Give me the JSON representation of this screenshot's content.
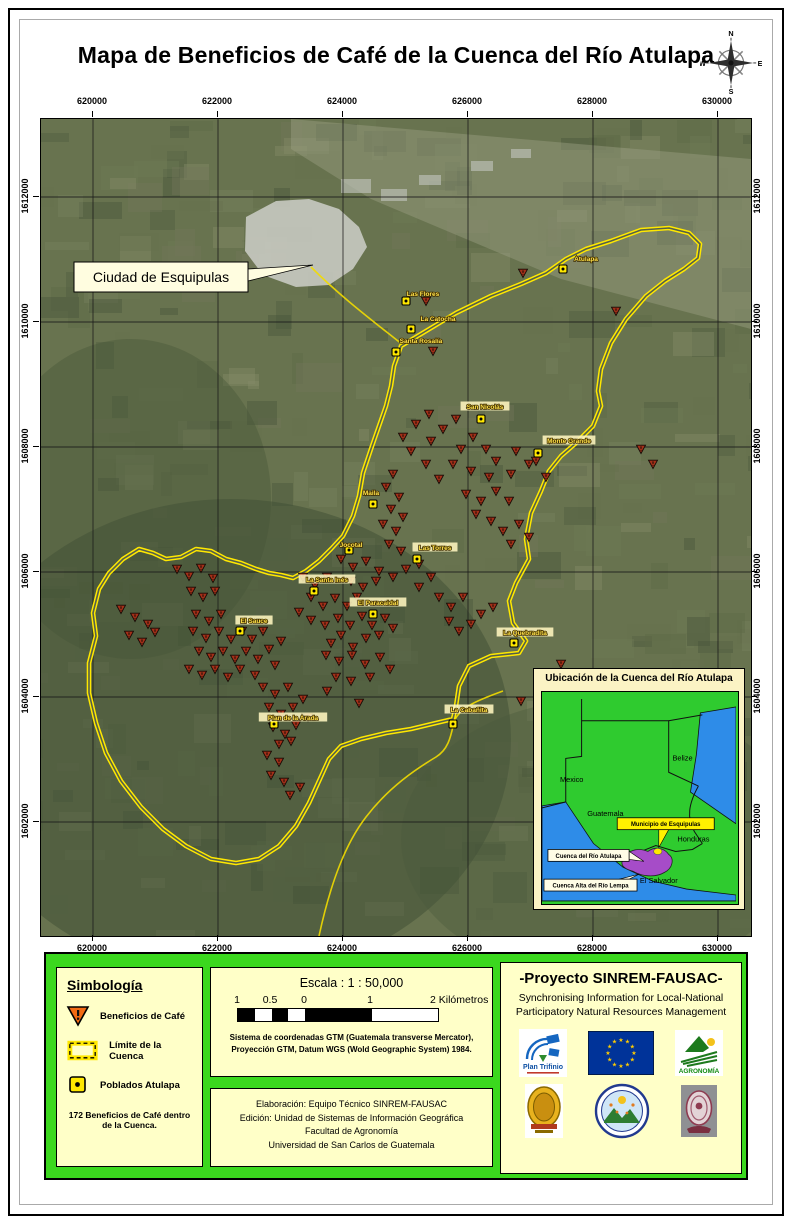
{
  "title": "Mapa de Beneficios de Café de la Cuenca del Río Atulapa",
  "compass": {
    "n": "N",
    "e": "E",
    "s": "S",
    "w": "W"
  },
  "map": {
    "x_ticks": [
      "620000",
      "622000",
      "624000",
      "626000",
      "628000",
      "630000"
    ],
    "y_ticks": [
      "1612000",
      "1610000",
      "1608000",
      "1606000",
      "1604000",
      "1602000"
    ],
    "city_callout": "Ciudad de Esquipulas",
    "boundary_points": "360,227 385,212 415,194 450,177 480,165 505,154 525,140 545,130 570,122 600,111 628,109 648,114 659,125 657,139 643,150 624,162 605,177 585,200 570,224 560,250 557,272 560,287 552,307 535,324 520,337 508,352 500,372 490,394 485,420 488,440 475,464 468,482 472,504 485,522 478,534 450,537 428,547 418,567 415,587 412,600 395,604 370,610 345,614 320,620 300,627 288,640 278,662 268,684 255,707 238,727 218,740 195,744 170,740 145,727 122,710 100,688 80,662 65,634 55,604 48,574 48,544 55,517 52,494 58,470 68,454 82,440 98,430 112,434 125,440 140,438 155,430 170,432 185,440 200,444 215,450 228,454 240,456 252,459 265,452 278,442 290,430 302,417 312,397 318,377 322,354 330,330 338,307 345,287 350,267 353,247",
    "towns": [
      {
        "name": "Atulapa",
        "lx": 545,
        "ly": 140,
        "mx": 522,
        "my": 150,
        "boxed": false
      },
      {
        "name": "Las Flores",
        "lx": 382,
        "ly": 175,
        "mx": 365,
        "my": 182,
        "boxed": false
      },
      {
        "name": "La Catocha",
        "lx": 397,
        "ly": 200,
        "mx": 370,
        "my": 210,
        "boxed": false
      },
      {
        "name": "Santa Rosalía",
        "lx": 380,
        "ly": 222,
        "mx": 355,
        "my": 233,
        "boxed": false
      },
      {
        "name": "San Nicolás",
        "lx": 444,
        "ly": 288,
        "mx": 440,
        "my": 300,
        "boxed": true
      },
      {
        "name": "Monte Grande",
        "lx": 528,
        "ly": 322,
        "mx": 497,
        "my": 334,
        "boxed": true
      },
      {
        "name": "Maila",
        "lx": 330,
        "ly": 374,
        "mx": 332,
        "my": 385,
        "boxed": false
      },
      {
        "name": "Jocotal",
        "lx": 310,
        "ly": 426,
        "mx": 308,
        "my": 431,
        "boxed": false
      },
      {
        "name": "Las Torres",
        "lx": 394,
        "ly": 429,
        "mx": 376,
        "my": 440,
        "boxed": true
      },
      {
        "name": "La Santa Inés",
        "lx": 286,
        "ly": 461,
        "mx": 273,
        "my": 472,
        "boxed": true
      },
      {
        "name": "El Paracaidal",
        "lx": 337,
        "ly": 484,
        "mx": 332,
        "my": 495,
        "boxed": true
      },
      {
        "name": "El Sauce",
        "lx": 213,
        "ly": 502,
        "mx": 199,
        "my": 512,
        "boxed": true
      },
      {
        "name": "La Quebradita",
        "lx": 484,
        "ly": 514,
        "mx": 473,
        "my": 524,
        "boxed": true
      },
      {
        "name": "Plan de la Arada",
        "lx": 252,
        "ly": 599,
        "mx": 233,
        "my": 605,
        "boxed": true
      },
      {
        "name": "La Cabañita",
        "lx": 428,
        "ly": 591,
        "mx": 412,
        "my": 605,
        "boxed": true
      }
    ],
    "beneficios": [
      [
        385,
        182
      ],
      [
        482,
        154
      ],
      [
        575,
        192
      ],
      [
        392,
        232
      ],
      [
        600,
        330
      ],
      [
        612,
        345
      ],
      [
        375,
        305
      ],
      [
        388,
        295
      ],
      [
        402,
        310
      ],
      [
        415,
        300
      ],
      [
        390,
        322
      ],
      [
        420,
        330
      ],
      [
        432,
        318
      ],
      [
        445,
        330
      ],
      [
        455,
        342
      ],
      [
        448,
        358
      ],
      [
        430,
        352
      ],
      [
        412,
        345
      ],
      [
        398,
        360
      ],
      [
        385,
        345
      ],
      [
        370,
        332
      ],
      [
        362,
        318
      ],
      [
        475,
        332
      ],
      [
        488,
        345
      ],
      [
        470,
        355
      ],
      [
        495,
        342
      ],
      [
        505,
        358
      ],
      [
        425,
        375
      ],
      [
        440,
        382
      ],
      [
        455,
        372
      ],
      [
        468,
        382
      ],
      [
        435,
        395
      ],
      [
        450,
        402
      ],
      [
        462,
        412
      ],
      [
        478,
        405
      ],
      [
        488,
        418
      ],
      [
        470,
        425
      ],
      [
        352,
        355
      ],
      [
        345,
        368
      ],
      [
        358,
        378
      ],
      [
        350,
        390
      ],
      [
        362,
        398
      ],
      [
        355,
        412
      ],
      [
        342,
        405
      ],
      [
        348,
        425
      ],
      [
        360,
        432
      ],
      [
        300,
        440
      ],
      [
        312,
        448
      ],
      [
        325,
        442
      ],
      [
        338,
        452
      ],
      [
        352,
        458
      ],
      [
        365,
        450
      ],
      [
        378,
        445
      ],
      [
        390,
        458
      ],
      [
        310,
        462
      ],
      [
        322,
        468
      ],
      [
        335,
        462
      ],
      [
        378,
        468
      ],
      [
        262,
        458
      ],
      [
        274,
        466
      ],
      [
        286,
        458
      ],
      [
        270,
        478
      ],
      [
        282,
        487
      ],
      [
        294,
        479
      ],
      [
        306,
        487
      ],
      [
        316,
        478
      ],
      [
        258,
        493
      ],
      [
        270,
        501
      ],
      [
        284,
        506
      ],
      [
        297,
        499
      ],
      [
        309,
        506
      ],
      [
        321,
        497
      ],
      [
        331,
        506
      ],
      [
        344,
        499
      ],
      [
        352,
        509
      ],
      [
        338,
        516
      ],
      [
        325,
        519
      ],
      [
        300,
        516
      ],
      [
        290,
        524
      ],
      [
        312,
        528
      ],
      [
        150,
        472
      ],
      [
        162,
        478
      ],
      [
        174,
        472
      ],
      [
        136,
        450
      ],
      [
        148,
        457
      ],
      [
        160,
        449
      ],
      [
        172,
        459
      ],
      [
        80,
        490
      ],
      [
        94,
        498
      ],
      [
        107,
        505
      ],
      [
        88,
        516
      ],
      [
        101,
        523
      ],
      [
        114,
        513
      ],
      [
        155,
        495
      ],
      [
        168,
        502
      ],
      [
        180,
        495
      ],
      [
        152,
        512
      ],
      [
        165,
        519
      ],
      [
        178,
        512
      ],
      [
        190,
        520
      ],
      [
        201,
        512
      ],
      [
        211,
        520
      ],
      [
        222,
        512
      ],
      [
        158,
        532
      ],
      [
        170,
        538
      ],
      [
        182,
        532
      ],
      [
        194,
        540
      ],
      [
        205,
        532
      ],
      [
        217,
        540
      ],
      [
        228,
        530
      ],
      [
        240,
        522
      ],
      [
        148,
        550
      ],
      [
        161,
        556
      ],
      [
        174,
        550
      ],
      [
        187,
        558
      ],
      [
        199,
        550
      ],
      [
        214,
        556
      ],
      [
        234,
        546
      ],
      [
        285,
        536
      ],
      [
        298,
        542
      ],
      [
        311,
        536
      ],
      [
        324,
        545
      ],
      [
        339,
        538
      ],
      [
        295,
        558
      ],
      [
        310,
        562
      ],
      [
        329,
        558
      ],
      [
        349,
        550
      ],
      [
        286,
        572
      ],
      [
        222,
        568
      ],
      [
        234,
        575
      ],
      [
        247,
        568
      ],
      [
        228,
        588
      ],
      [
        240,
        595
      ],
      [
        252,
        588
      ],
      [
        262,
        580
      ],
      [
        232,
        608
      ],
      [
        244,
        615
      ],
      [
        255,
        606
      ],
      [
        267,
        598
      ],
      [
        238,
        625
      ],
      [
        250,
        622
      ],
      [
        226,
        636
      ],
      [
        238,
        643
      ],
      [
        230,
        656
      ],
      [
        243,
        663
      ],
      [
        249,
        676
      ],
      [
        259,
        668
      ],
      [
        480,
        582
      ],
      [
        505,
        595
      ],
      [
        520,
        545
      ],
      [
        318,
        584
      ],
      [
        398,
        478
      ],
      [
        410,
        488
      ],
      [
        422,
        478
      ],
      [
        408,
        502
      ],
      [
        418,
        512
      ],
      [
        430,
        505
      ],
      [
        440,
        495
      ],
      [
        452,
        488
      ]
    ]
  },
  "inset": {
    "title": "Ubicación de la Cuenca del Río Atulapa",
    "countries": [
      "Mexico",
      "Guatemala",
      "Belize",
      "Honduras",
      "El Salvador"
    ],
    "callouts": [
      "Municipio de Esquipulas",
      "Cuenca del Río Atulapa",
      "Cuenca Alta del Río Lempa"
    ]
  },
  "legend": {
    "heading": "Simbología",
    "items": [
      {
        "icon": "beneficio-triangle-icon",
        "label": "Beneficios de Café"
      },
      {
        "icon": "cuenca-boundary-icon",
        "label": "Límite de la Cuenca"
      },
      {
        "icon": "poblado-icon",
        "label": "Poblados Atulapa"
      }
    ],
    "note": "172 Beneficios de Café dentro de la Cuenca."
  },
  "scale": {
    "title": "Escala : 1 : 50,000",
    "bar_labels": [
      "1",
      "0.5",
      "0",
      "1",
      "2 Kilómetros"
    ],
    "crs_line1": "Sistema de coordenadas GTM (Guatemala transverse Mercator),",
    "crs_line2": "Proyección GTM, Datum WGS (Wold Geographic System) 1984."
  },
  "credits": {
    "lines": [
      "Elaboración: Equipo Técnico SINREM-FAUSAC",
      "Edición: Unidad de Sistemas de Información Geográfica",
      "Facultad de Agronomía",
      "Universidad de San Carlos de Guatemala"
    ]
  },
  "project": {
    "title": "-Proyecto SINREM-FAUSAC-",
    "subtitle_line1": "Synchronising Information for Local-National",
    "subtitle_line2": "Participatory Natural Resources Management",
    "logo_plan_trifinio": "Plan Trifinio",
    "logo_agronomia": "AGRONOMÍA"
  },
  "colors": {
    "panel_green": "#3BD81E",
    "cream": "#FFFFC8",
    "boundary_yellow": "#FFE800",
    "beneficio_red": "#A33019",
    "legend_triangle_orange": "#F26A13",
    "inset_land_green": "#2FCB2F",
    "inset_sea_blue": "#2E8CE8",
    "inset_lempa_purple": "#A64CC8",
    "eu_flag_blue": "#003399"
  }
}
